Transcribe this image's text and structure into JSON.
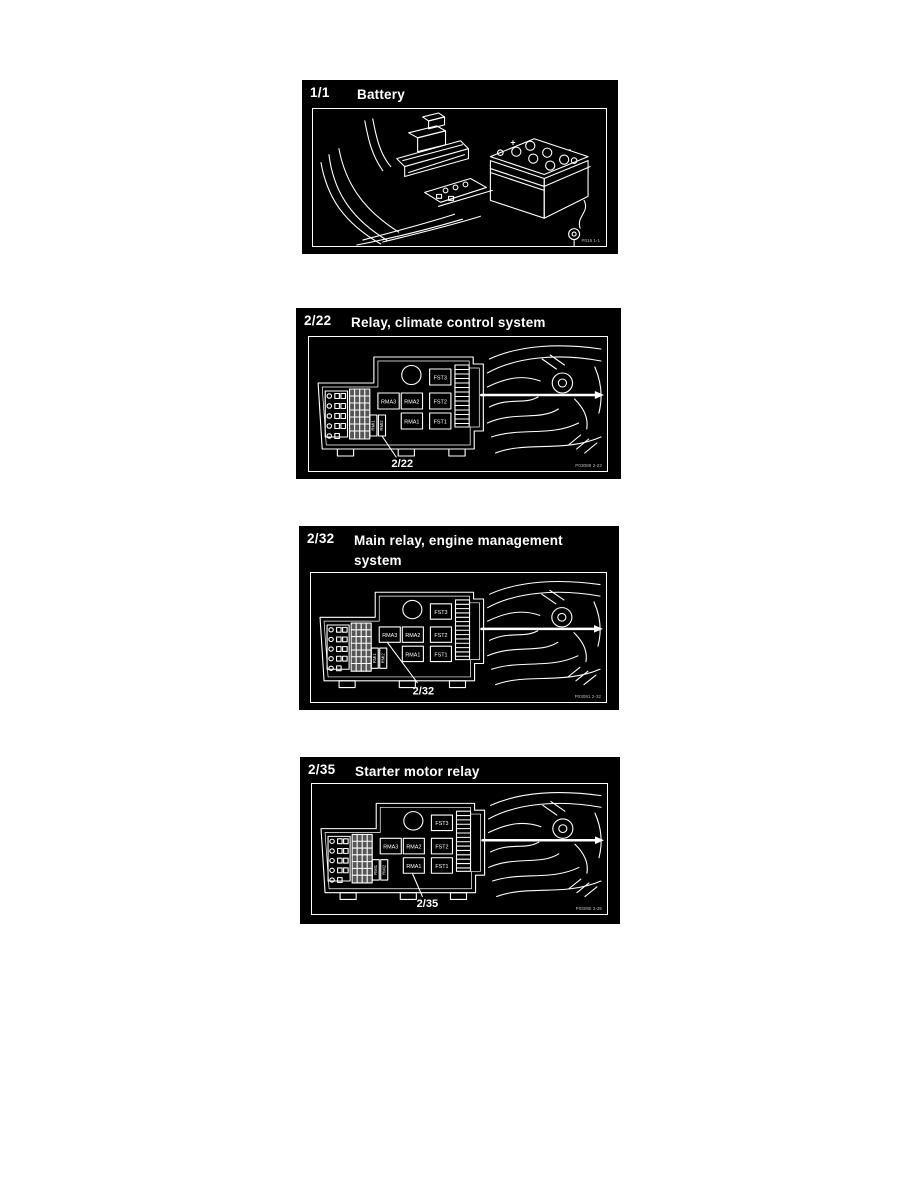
{
  "page": {
    "background": "#ffffff",
    "panel_bg": "#000000",
    "line_color": "#ffffff"
  },
  "panels": [
    {
      "ref": "1/1",
      "title": "Battery",
      "caption": "P016 1-1",
      "type": "battery",
      "battery_plus": "+",
      "battery_minus": "-"
    },
    {
      "ref": "2/22",
      "title": "Relay, climate control system",
      "caption": "P03088 2-22",
      "type": "relay-box",
      "callout_label": "2/22",
      "labels": {
        "rma3": "RMA3",
        "rma2": "RMA2",
        "rma1": "RMA1",
        "fst3": "FST3",
        "fst2": "FST2",
        "fst1": "FST1",
        "rmi1": "RMI1",
        "rmi2": "RMI2"
      }
    },
    {
      "ref": "2/32",
      "title": "Main relay, engine management system",
      "caption": "P03081 2-32",
      "type": "relay-box",
      "callout_label": "2/32",
      "labels": {
        "rma3": "RMA3",
        "rma2": "RMA2",
        "rma1": "RMA1",
        "fst3": "FST3",
        "fst2": "FST2",
        "fst1": "FST1",
        "rmi1": "RMI1",
        "rmi2": "RMI2"
      }
    },
    {
      "ref": "2/35",
      "title": "Starter motor relay",
      "caption": "P03085 2-35",
      "type": "relay-box",
      "callout_label": "2/35",
      "labels": {
        "rma3": "RMA3",
        "rma2": "RMA2",
        "rma1": "RMA1",
        "fst3": "FST3",
        "fst2": "FST2",
        "fst1": "FST1",
        "rmi1": "RMI1",
        "rmi2": "RMI2"
      }
    }
  ]
}
